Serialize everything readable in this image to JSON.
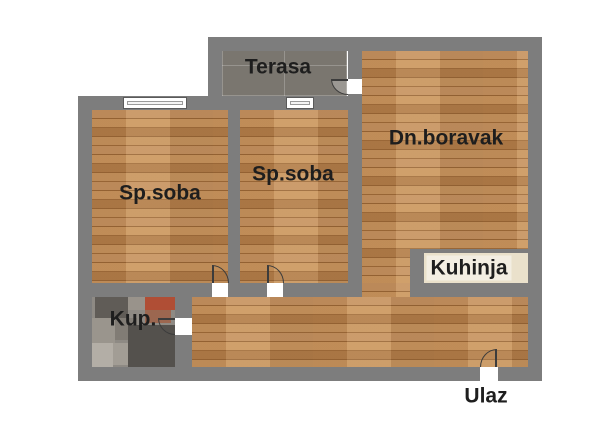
{
  "plan": {
    "labels": {
      "terrace": "Terasa",
      "bedroom1": "Sp.soba",
      "bedroom2": "Sp.soba",
      "living_room": "Dn.boravak",
      "kitchen": "Kuhinja",
      "bathroom": "Kup.",
      "entrance": "Ulaz"
    },
    "colors": {
      "wall": "#7d7d7d",
      "wood_base": "#bf8750",
      "terrace_floor": "#7a766f",
      "kitchen_counter": "#eae1cb",
      "bathroom_base": "#8e8a84",
      "label_text": "#1e1e1e",
      "background": "#ffffff"
    }
  }
}
